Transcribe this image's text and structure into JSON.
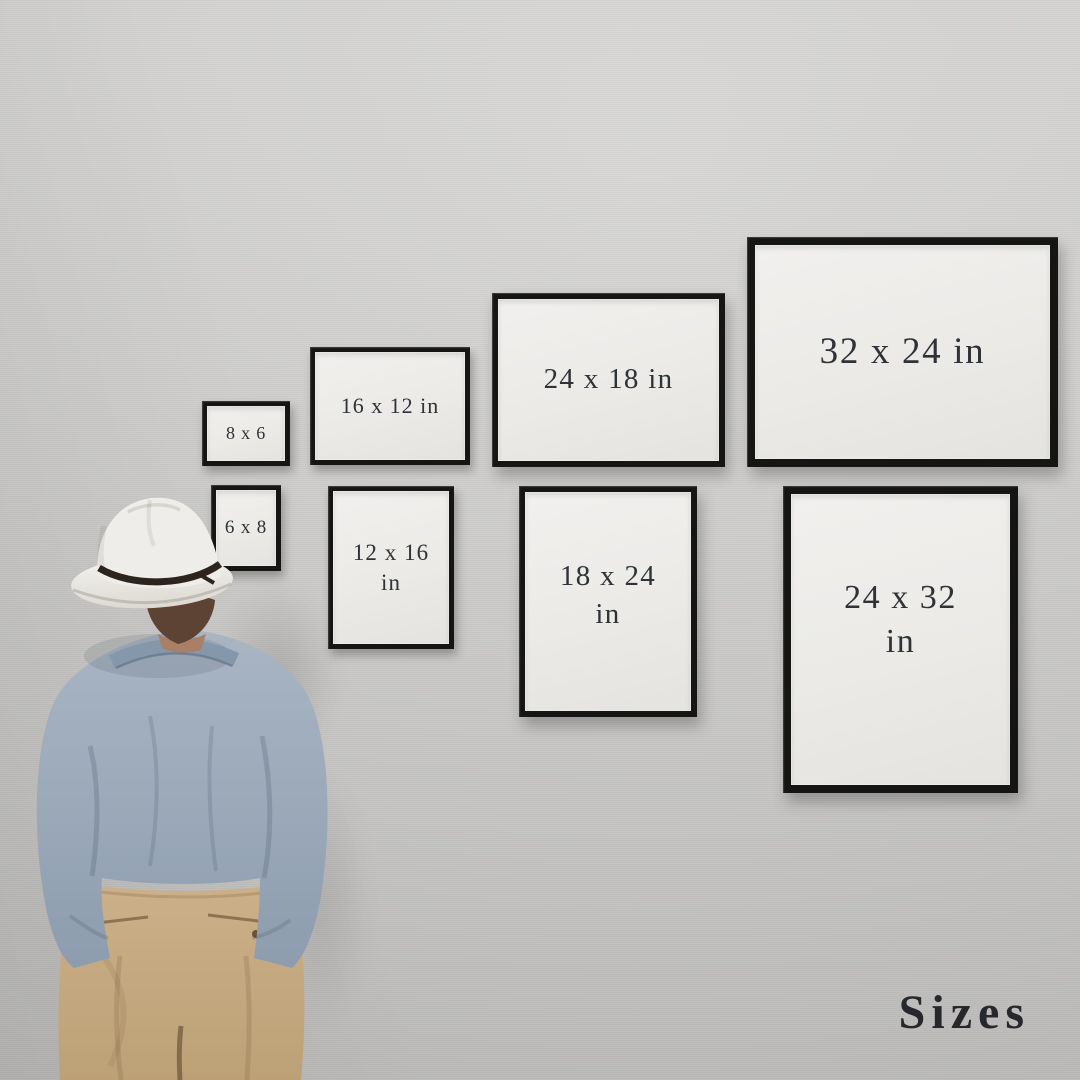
{
  "scene": {
    "title": "Sizes",
    "title_color": "#26282c",
    "wall_color": "#cfcecc",
    "frame_border_color": "#151514",
    "frame_paper_color": "#ebeae7",
    "frame_label_color": "#2f3237"
  },
  "frames": [
    {
      "name": "frame-8x6",
      "orientation": "landscape",
      "line1": "8 x 6",
      "line2": ""
    },
    {
      "name": "frame-16x12",
      "orientation": "landscape",
      "line1": "16 x 12 in",
      "line2": ""
    },
    {
      "name": "frame-24x18",
      "orientation": "landscape",
      "line1": "24 x 18 in",
      "line2": ""
    },
    {
      "name": "frame-32x24",
      "orientation": "landscape",
      "line1": "32 x 24 in",
      "line2": ""
    },
    {
      "name": "frame-6x8",
      "orientation": "portrait",
      "line1": "6 x 8",
      "line2": ""
    },
    {
      "name": "frame-12x16",
      "orientation": "portrait",
      "line1": "12 x 16",
      "line2": "in"
    },
    {
      "name": "frame-18x24",
      "orientation": "portrait",
      "line1": "18 x 24",
      "line2": "in"
    },
    {
      "name": "frame-24x32",
      "orientation": "portrait",
      "line1": "24 x 32",
      "line2": "in"
    }
  ],
  "figure": {
    "description": "man seen from behind looking at the framed size chart",
    "hat_color": "#efede9",
    "hat_band_color": "#2c241d",
    "hair_color": "#5c4334",
    "shirt_color": "#9cabba",
    "pants_color": "#c4a87f"
  }
}
